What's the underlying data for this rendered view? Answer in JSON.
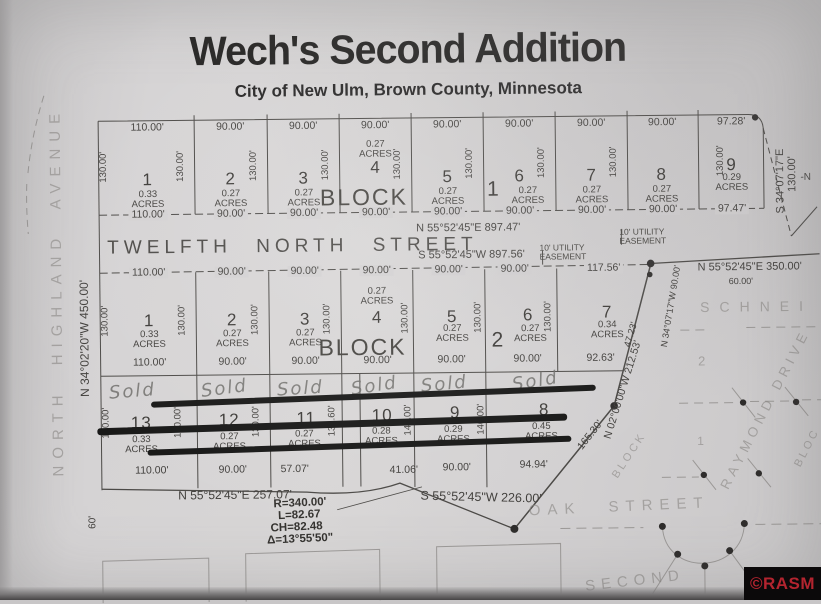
{
  "header": {
    "title": "Wech's Second Addition",
    "subtitle": "City of New Ulm, Brown County, Minnesota"
  },
  "streets": {
    "twelfth": "TWELFTH NORTH STREET",
    "oak": "OAK STREET",
    "highland": "NORTH HIGHLAND AVENUE",
    "raymond": "RAYMOND DRIVE",
    "schneider": "SCHNEI",
    "second": "SECOND"
  },
  "boundary": {
    "west": "N 34°02'20\"W 450.00'",
    "twelfth_north": "N 55°52'45\"E 897.47'",
    "twelfth_south": "S 55°52'45\"W 897.56'",
    "utility_easement": "10' UTILITY EASEMENT",
    "block1_east_bearing": "S 34°07'17\"E",
    "block1_east_dist": "130.00'",
    "northeast": "N 55°52'45\"E 350.00'",
    "northeast_offset": "60.00'",
    "lot7_east": "N 34°07'17\"W 90.00'",
    "lot7_diag": "47.23'",
    "southeast_diag": "N 02°00'00\"W 212.53'",
    "southeast_diag2": "165.30'",
    "south_west_seg": "N 55°52'45\"E 257.07'",
    "south_east_seg": "S 55°52'45\"W 226.00'",
    "sixty": "60'",
    "partial_n": "-N"
  },
  "curve": {
    "radius": "R=340.00'",
    "length": "L=82.67",
    "chord": "CH=82.48",
    "delta": "Δ=13°55'50\""
  },
  "faint": {
    "block": "BLOCK",
    "block_partial": "BLOC",
    "lot1": "1",
    "lot2": "2"
  },
  "block1": {
    "label": "BLOCK",
    "number": "1",
    "acres_word": "ACRES",
    "side": "130.00'",
    "lots": [
      {
        "n": "1",
        "a": "0.33",
        "top": "110.00'",
        "bot": "110.00'"
      },
      {
        "n": "2",
        "a": "0.27",
        "top": "90.00'",
        "bot": "90.00'"
      },
      {
        "n": "3",
        "a": "0.27",
        "top": "90.00'",
        "bot": "90.00'"
      },
      {
        "n": "4",
        "a": "0.27",
        "top": "90.00'",
        "bot": "90.00'"
      },
      {
        "n": "5",
        "a": "0.27",
        "top": "90.00'",
        "bot": "90.00'"
      },
      {
        "n": "6",
        "a": "0.27",
        "top": "90.00'",
        "bot": "90.00'"
      },
      {
        "n": "7",
        "a": "0.27",
        "top": "90.00'",
        "bot": "90.00'"
      },
      {
        "n": "8",
        "a": "0.27",
        "top": "90.00'",
        "bot": "90.00'"
      },
      {
        "n": "9",
        "a": "0.29",
        "top": "97.28'",
        "bot": "97.47'"
      }
    ]
  },
  "block2": {
    "label": "BLOCK",
    "number": "2",
    "acres_word": "ACRES",
    "side": "130.00'",
    "lots": [
      {
        "n": "1",
        "a": "0.33",
        "top": "110.00'",
        "bot": "110.00'"
      },
      {
        "n": "2",
        "a": "0.27",
        "top": "90.00'",
        "bot": "90.00'"
      },
      {
        "n": "3",
        "a": "0.27",
        "top": "90.00'",
        "bot": "90.00'"
      },
      {
        "n": "4",
        "a": "0.27",
        "top": "90.00'",
        "bot": "90.00'"
      },
      {
        "n": "5",
        "a": "0.27",
        "top": "90.00'",
        "bot": "90.00'"
      },
      {
        "n": "6",
        "a": "0.27",
        "top": "90.00'",
        "bot": "90.00'"
      },
      {
        "n": "7",
        "a": "0.34",
        "top": "117.56'",
        "bot": "92.63'"
      }
    ],
    "south_lots": [
      {
        "n": "13",
        "a": "0.33",
        "bot": "110.00'",
        "side": "130.00'",
        "sold": "Sold"
      },
      {
        "n": "12",
        "a": "0.27",
        "bot": "90.00'",
        "side": "130.00'",
        "sold": "Sold"
      },
      {
        "n": "11",
        "a": "0.27",
        "bot": "57.07'",
        "side": "130.00'",
        "sold": "Sold"
      },
      {
        "n": "10",
        "a": "0.28",
        "bot": "41.06'",
        "side": "131.60'",
        "sold": "Sold"
      },
      {
        "n": "9",
        "a": "0.29",
        "bot": "90.00'",
        "side": "140.00'",
        "sold": "Sold"
      },
      {
        "n": "8",
        "a": "0.45",
        "bot": "94.94'",
        "side": "140.00'",
        "sold": "Sold"
      }
    ]
  },
  "watermark": "©RASM"
}
